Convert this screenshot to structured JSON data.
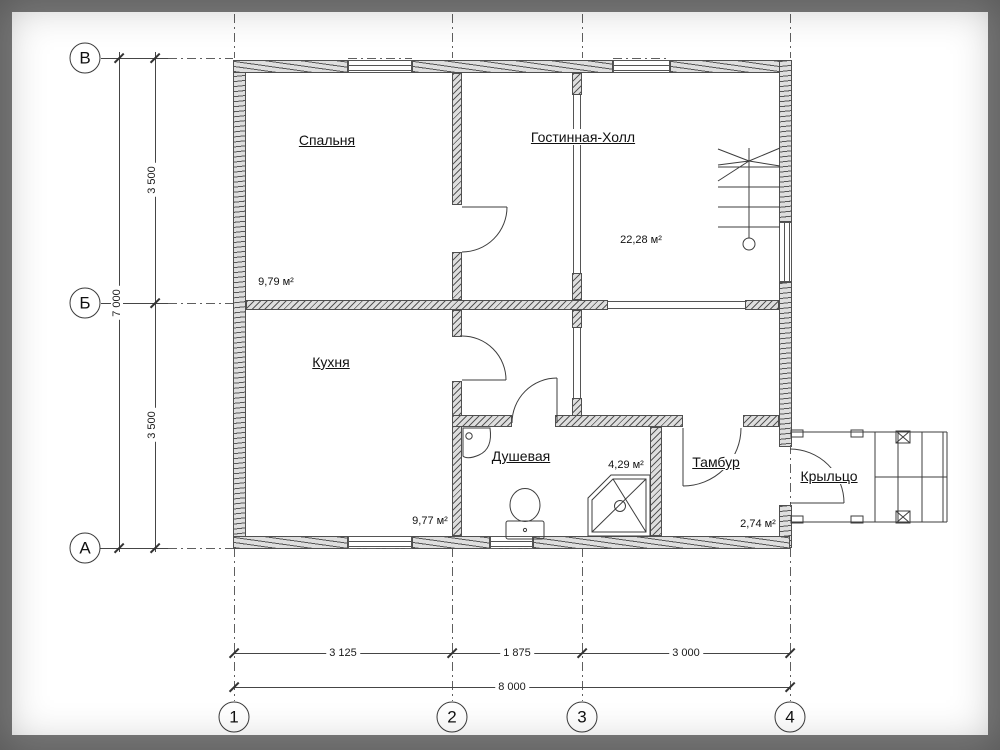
{
  "axes": {
    "rows": [
      "В",
      "Б",
      "А"
    ],
    "cols": [
      "1",
      "2",
      "3",
      "4"
    ]
  },
  "dims": {
    "v1": "3 500",
    "v2": "3 500",
    "v_total": "7 000",
    "h1": "3 125",
    "h2": "1 875",
    "h3": "3 000",
    "h_total": "8 000"
  },
  "rooms": {
    "bedroom": {
      "name": "Спальня",
      "area": "9,79 м²"
    },
    "living": {
      "name": "Гостинная-Холл",
      "area": "22,28 м²"
    },
    "kitchen": {
      "name": "Кухня",
      "area": "9,77 м²"
    },
    "shower": {
      "name": "Душевая",
      "area": "4,29 м²"
    },
    "tambour": {
      "name": "Тамбур",
      "area": "2,74 м²"
    },
    "porch": {
      "name": "Крыльцо"
    }
  },
  "icons": {
    "doors": [
      "door-bedroom",
      "door-kitchen",
      "door-shower",
      "door-tambour",
      "door-entry"
    ],
    "fixtures": [
      "stairs",
      "toilet",
      "sink",
      "shower-tray",
      "porch-steps"
    ]
  },
  "colors": {
    "frame": "#7c7c7c",
    "paper": "#ffffff",
    "line": "#3d3d3d",
    "wall_fill": "#dedede",
    "hatch": "#565656"
  }
}
